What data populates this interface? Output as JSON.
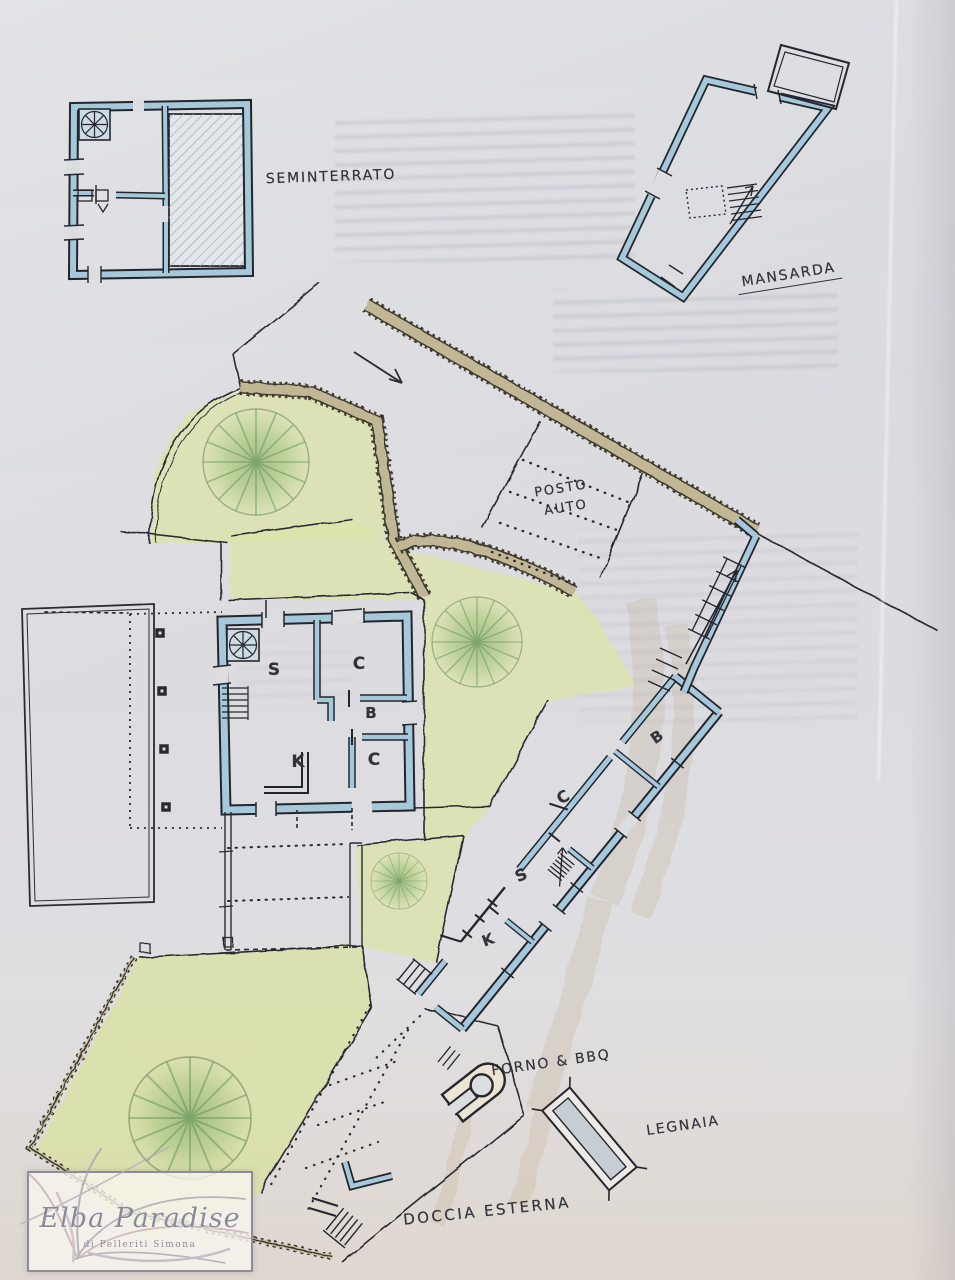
{
  "plans": {
    "seminterrato": {
      "label": "SEMINTERRATO"
    },
    "mansarda": {
      "label": "MANSARDA"
    },
    "main_floor": {
      "rooms": [
        {
          "label": "S"
        },
        {
          "label": "C"
        },
        {
          "label": "B"
        },
        {
          "label": "K"
        },
        {
          "label": "C"
        }
      ]
    },
    "annex": {
      "rooms": [
        {
          "label": "B"
        },
        {
          "label": "C"
        },
        {
          "label": "S"
        },
        {
          "label": "K"
        }
      ]
    },
    "site": {
      "parking": {
        "line1": "POSTO",
        "line2": "AUTO"
      },
      "forno_label": "FORNO & BBQ",
      "legnaia_label": "LEGNAIA",
      "doccia_label": "DOCCIA ESTERNA"
    }
  },
  "watermark": {
    "title": "Elba Paradise",
    "subtitle": "di Pelleriti Simona"
  },
  "colors": {
    "paper": "#dcdde1",
    "ink": "#26262e",
    "wall_blue": "#a5c9db",
    "garden_green": "#dce3ab",
    "hedge_tan": "#c2b795"
  }
}
